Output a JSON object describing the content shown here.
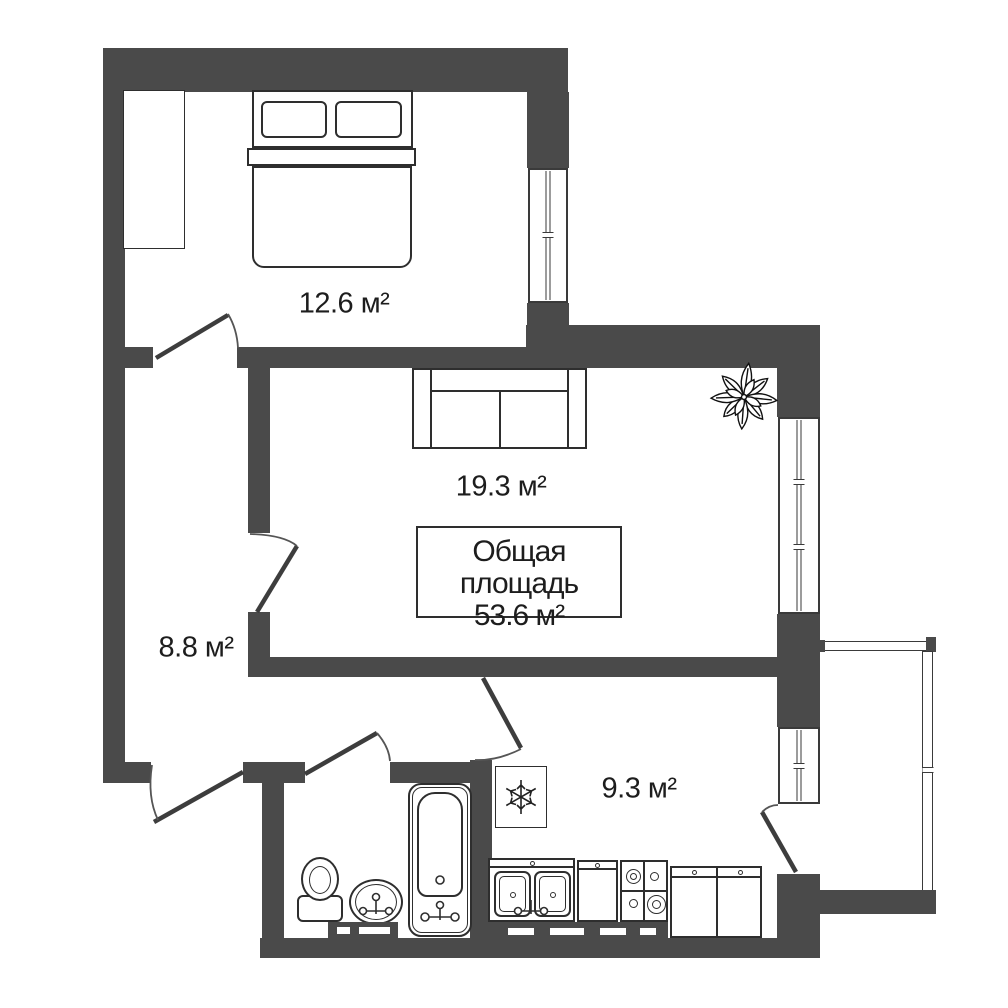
{
  "labels": {
    "bedroom": "12.6 м²",
    "living": "19.3 м²",
    "hall": "8.8 м²",
    "kitchen": "9.3 м²",
    "total_line1": "Общая площадь",
    "total_line2": "53.6 м²"
  },
  "colors": {
    "wall": "#4a4a4a",
    "outline": "#2e2e2e",
    "background": "#ffffff"
  },
  "icons": {
    "fridge": "snowflake-icon",
    "plant": "plant-icon"
  }
}
